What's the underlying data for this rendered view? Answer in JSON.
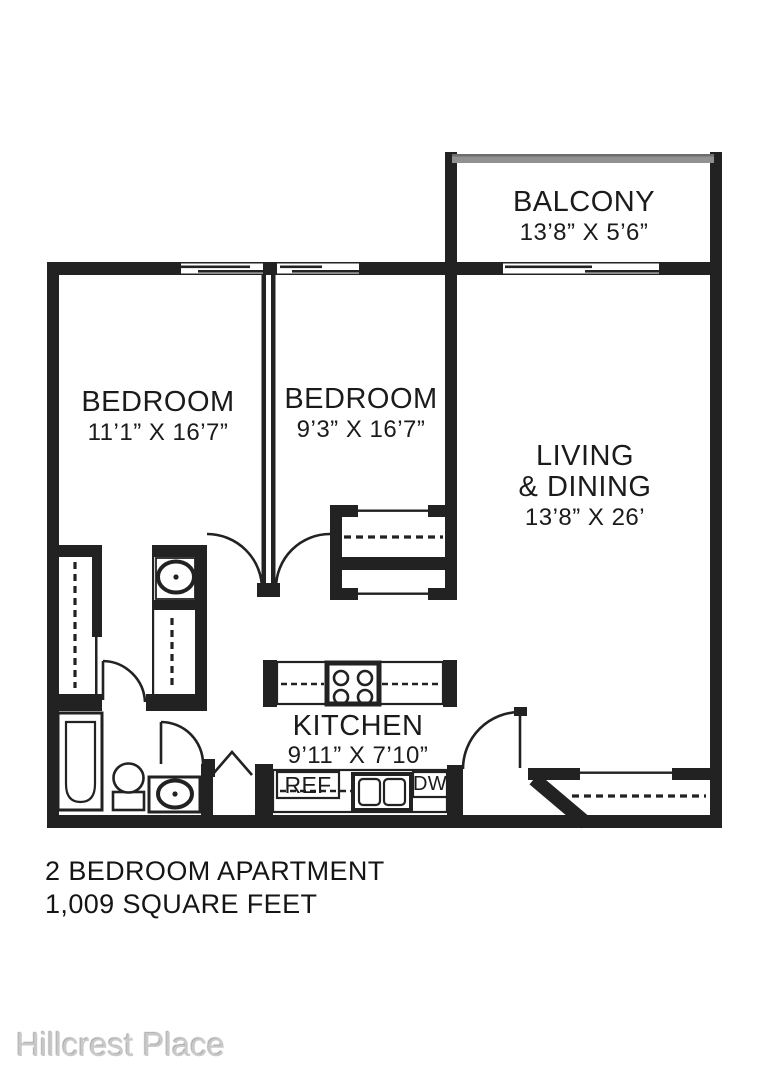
{
  "floor_plan": {
    "rooms": {
      "balcony": {
        "name": "BALCONY",
        "dims": "13’8” X 5’6”"
      },
      "bedroom1": {
        "name": "BEDROOM",
        "dims": "11’1” X 16’7”"
      },
      "bedroom2": {
        "name": "BEDROOM",
        "dims": "9’3” X 16’7”"
      },
      "living": {
        "name_line1": "LIVING",
        "name_line2": "& DINING",
        "dims": "13’8” X 26’"
      },
      "kitchen": {
        "name": "KITCHEN",
        "dims": "9’11” X 7’10”"
      }
    },
    "appliances": {
      "refrigerator": "REF",
      "dishwasher": "DW"
    },
    "summary": {
      "line1": "2 BEDROOM APARTMENT",
      "line2": "1,009 SQUARE FEET"
    },
    "watermark": "Hillcrest Place",
    "colors": {
      "wall": "#222222",
      "railing": "#919191",
      "background": "#ffffff",
      "watermark": "#c9c9c9"
    }
  }
}
